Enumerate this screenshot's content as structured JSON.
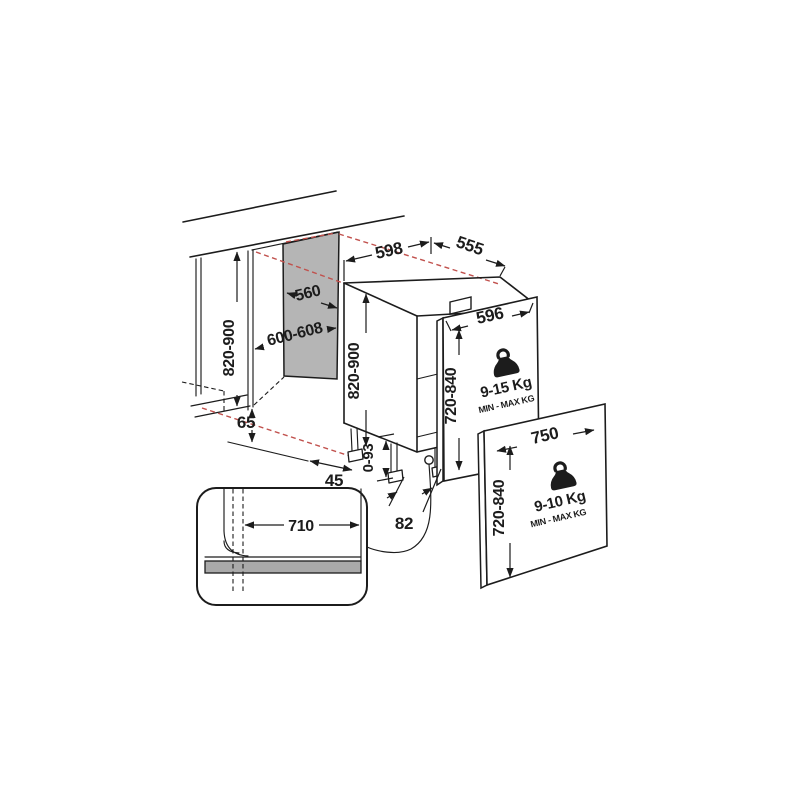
{
  "diagram_title": "built-in-dishwasher-installation-dimensions",
  "labels": {
    "niche_height": "820-900",
    "niche_depth": "560",
    "niche_width": "600-608",
    "plinth_gap": "65",
    "dw_width": "598",
    "dw_depth": "555",
    "dw_height": "820-900",
    "foot_adjust_range": "0-93",
    "foot_front_offset": "82",
    "foot_back_offset": "45",
    "panel1_width": "596",
    "panel1_height": "720-840",
    "panel1_weight": "9-15 Kg",
    "panel1_weight_caption": "MIN - MAX KG",
    "panel2_width": "750",
    "panel2_height": "720-840",
    "panel2_weight": "9-10 Kg",
    "panel2_weight_caption": "MIN - MAX KG",
    "plinth_cutout_width": "710"
  },
  "colors": {
    "line": "#1c1c1c",
    "panel_gray": "#b5b5b5",
    "bar_gray": "#a9a9a9",
    "projection_red": "#c1514d"
  }
}
